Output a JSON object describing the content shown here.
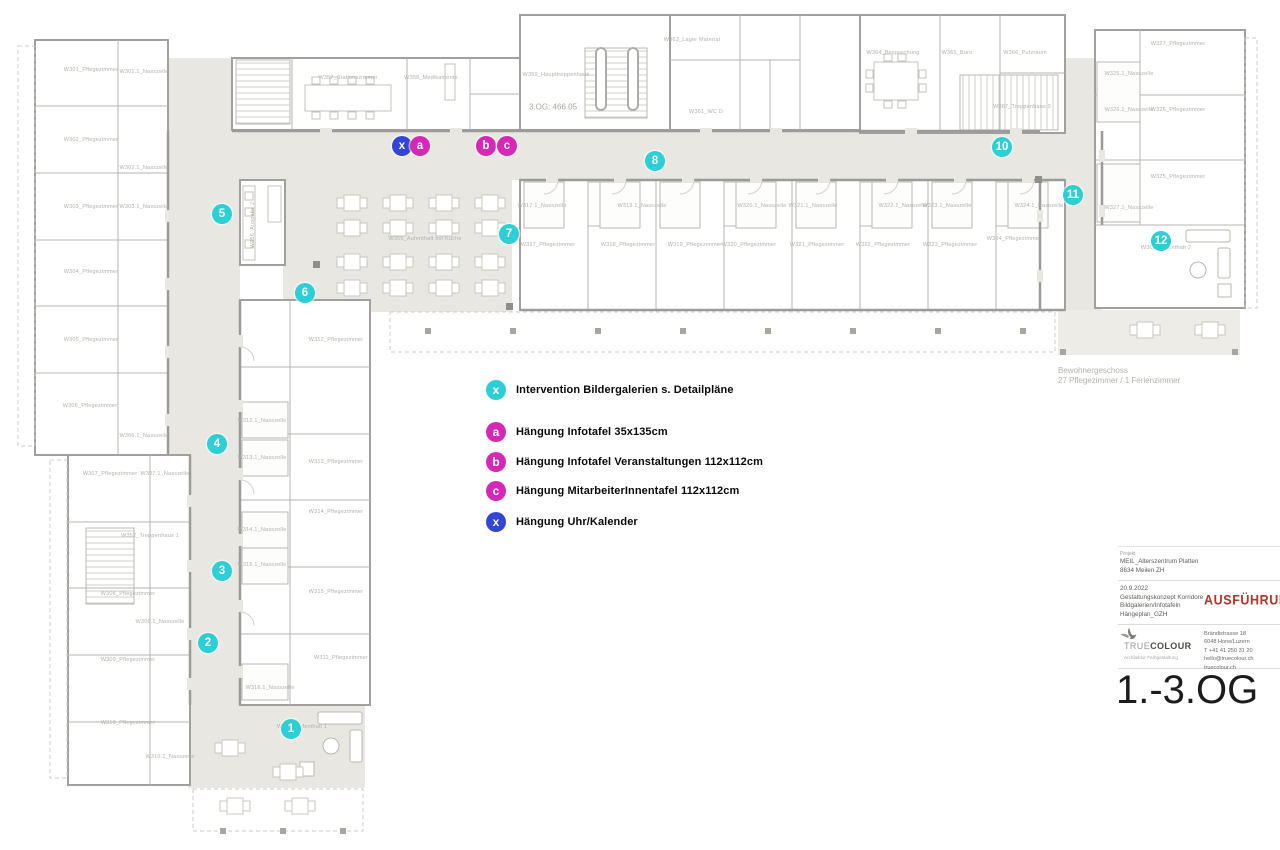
{
  "document": {
    "floor_title": "1.-3.OG",
    "level_note": "3.OG: 466.05",
    "area_note_line1": "Bewohnergeschoss",
    "area_note_line2": "27 Pflegezimmer / 1 Ferienzimmer"
  },
  "colors": {
    "cyan": "#2ccfd6",
    "magenta": "#d628b6",
    "blue": "#3345d4",
    "red": "#b23427",
    "corridor": "#e8e7e1"
  },
  "legend": {
    "items": [
      {
        "symbol": "x",
        "color": "cyan",
        "label": "Intervention Bildergalerien s. Detailpläne",
        "y": 390
      },
      {
        "symbol": "a",
        "color": "magenta",
        "label": "Hängung Infotafel 35x135cm",
        "y": 432
      },
      {
        "symbol": "b",
        "color": "magenta",
        "label": "Hängung Infotafel Veranstaltungen 112x112cm",
        "y": 462
      },
      {
        "symbol": "c",
        "color": "magenta",
        "label": "Hängung MitarbeiterInnentafel 112x112cm",
        "y": 491
      },
      {
        "symbol": "x",
        "color": "blue",
        "label": "Hängung Uhr/Kalender",
        "y": 522
      }
    ]
  },
  "markers": {
    "numbered": [
      {
        "label": "1",
        "x": 291,
        "y": 729
      },
      {
        "label": "2",
        "x": 208,
        "y": 643
      },
      {
        "label": "3",
        "x": 222,
        "y": 571
      },
      {
        "label": "4",
        "x": 217,
        "y": 444
      },
      {
        "label": "5",
        "x": 222,
        "y": 214
      },
      {
        "label": "6",
        "x": 305,
        "y": 293
      },
      {
        "label": "7",
        "x": 509,
        "y": 234
      },
      {
        "label": "8",
        "x": 655,
        "y": 161
      },
      {
        "label": "10",
        "x": 1002,
        "y": 147
      },
      {
        "label": "11",
        "x": 1073,
        "y": 195
      },
      {
        "label": "12",
        "x": 1161,
        "y": 241
      }
    ],
    "lettered": [
      {
        "label": "x",
        "color": "blue",
        "x": 402,
        "y": 146
      },
      {
        "label": "a",
        "color": "magenta",
        "x": 420,
        "y": 146
      },
      {
        "label": "b",
        "color": "magenta",
        "x": 486,
        "y": 146
      },
      {
        "label": "c",
        "color": "magenta",
        "x": 507,
        "y": 146
      }
    ]
  },
  "rooms": [
    {
      "label": "W301_Pflegezimmer",
      "x": 91,
      "y": 70
    },
    {
      "label": "W301.1_Nasszelle",
      "x": 144,
      "y": 72
    },
    {
      "label": "W302_Pflegezimmer",
      "x": 91,
      "y": 140
    },
    {
      "label": "W302.1_Nasszelle",
      "x": 144,
      "y": 168
    },
    {
      "label": "W303_Pflegezimmer",
      "x": 91,
      "y": 207
    },
    {
      "label": "W303.1_Nasszelle",
      "x": 144,
      "y": 207
    },
    {
      "label": "W304_Pflegezimmer",
      "x": 91,
      "y": 272
    },
    {
      "label": "W305_Pflegezimmer",
      "x": 91,
      "y": 340
    },
    {
      "label": "W306_Pflegezimmer",
      "x": 90,
      "y": 406
    },
    {
      "label": "W306.1_Nasszelle",
      "x": 144,
      "y": 436
    },
    {
      "label": "W307_Pflegezimmer",
      "x": 110,
      "y": 474
    },
    {
      "label": "W307.1_Nasszelle",
      "x": 165,
      "y": 474
    },
    {
      "label": "W308_Pflegezimmer",
      "x": 128,
      "y": 594
    },
    {
      "label": "W308.1_Nasszelle",
      "x": 160,
      "y": 622
    },
    {
      "label": "W309_Pflegezimmer",
      "x": 128,
      "y": 660
    },
    {
      "label": "W310_Pflegezimmer",
      "x": 128,
      "y": 723
    },
    {
      "label": "W310.1_Nasszelle",
      "x": 170,
      "y": 757
    },
    {
      "label": "W352_Treppenhaus 1",
      "x": 150,
      "y": 536
    },
    {
      "label": "W311_Pflegezimmer",
      "x": 341,
      "y": 658
    },
    {
      "label": "W312_Pflegezimmer",
      "x": 336,
      "y": 340
    },
    {
      "label": "W312.1_Nasszelle",
      "x": 262,
      "y": 421
    },
    {
      "label": "W313_Pflegezimmer",
      "x": 336,
      "y": 462
    },
    {
      "label": "W313.1_Nasszelle",
      "x": 262,
      "y": 458
    },
    {
      "label": "W314_Pflegezimmer",
      "x": 336,
      "y": 512
    },
    {
      "label": "W314.1_Nasszelle",
      "x": 262,
      "y": 530
    },
    {
      "label": "W315_Pflegezimmer",
      "x": 336,
      "y": 592
    },
    {
      "label": "W315.1_Nasszelle",
      "x": 262,
      "y": 565
    },
    {
      "label": "W316.1_Nasszelle",
      "x": 270,
      "y": 688
    },
    {
      "label": "W351_Aufenthalt 1",
      "x": 302,
      "y": 727
    },
    {
      "label": "W355_Aufenthalt mit Küche",
      "x": 425,
      "y": 239
    },
    {
      "label": "W356_Ausgabe 2",
      "x": 253,
      "y": 225,
      "v": 1
    },
    {
      "label": "W357_Stationszimmer",
      "x": 348,
      "y": 78
    },
    {
      "label": "W358_Medikamente",
      "x": 431,
      "y": 78
    },
    {
      "label": "W359_Haupttreppenhaus",
      "x": 556,
      "y": 75
    },
    {
      "label": "W363_Lager Material",
      "x": 692,
      "y": 40
    },
    {
      "label": "W361_WC D",
      "x": 706,
      "y": 112
    },
    {
      "label": "W364_Besprechung",
      "x": 893,
      "y": 53
    },
    {
      "label": "W365_Büro",
      "x": 957,
      "y": 53
    },
    {
      "label": "W366_Putzraum",
      "x": 1025,
      "y": 53
    },
    {
      "label": "W367_Treppenhaus 3",
      "x": 1022,
      "y": 107
    },
    {
      "label": "W317.1_Nasszelle",
      "x": 542,
      "y": 206
    },
    {
      "label": "W317_Pflegezimmer",
      "x": 548,
      "y": 245
    },
    {
      "label": "W318_Pflegezimmer",
      "x": 628,
      "y": 245
    },
    {
      "label": "W319.1_Nasszelle",
      "x": 642,
      "y": 206
    },
    {
      "label": "W319_Pflegezimmer",
      "x": 695,
      "y": 245
    },
    {
      "label": "W320.1_Nasszelle",
      "x": 762,
      "y": 206
    },
    {
      "label": "W320_Pflegezimmer",
      "x": 749,
      "y": 245
    },
    {
      "label": "W321.1_Nasszelle",
      "x": 813,
      "y": 206
    },
    {
      "label": "W321_Pflegezimmer",
      "x": 817,
      "y": 245
    },
    {
      "label": "W322.1_Nasszelle",
      "x": 903,
      "y": 206
    },
    {
      "label": "W322_Pflegezimmer",
      "x": 883,
      "y": 245
    },
    {
      "label": "W323.1_Nasszelle",
      "x": 947,
      "y": 206
    },
    {
      "label": "W323_Pflegezimmer",
      "x": 950,
      "y": 245
    },
    {
      "label": "W324.1_Nasszelle",
      "x": 1039,
      "y": 206
    },
    {
      "label": "W324_Pflegezimmer",
      "x": 1014,
      "y": 239
    },
    {
      "label": "W327_Pflegezimmer",
      "x": 1178,
      "y": 44
    },
    {
      "label": "W325.1_Nasszelle",
      "x": 1129,
      "y": 74
    },
    {
      "label": "W326.1_Nasszelle",
      "x": 1129,
      "y": 110
    },
    {
      "label": "W326_Pflegezimmer",
      "x": 1178,
      "y": 110
    },
    {
      "label": "W325_Pflegezimmer",
      "x": 1178,
      "y": 177
    },
    {
      "label": "W327.1_Nasszelle",
      "x": 1129,
      "y": 208
    },
    {
      "label": "W369_Aufenthalt 2",
      "x": 1166,
      "y": 248
    }
  ],
  "titleblock": {
    "project_label": "Projekt",
    "project_lines": [
      "MEIL_Alterszentrum Platten",
      "8634 Meilen ZH"
    ],
    "revision_lines": [
      "20.9.2022",
      "Gestaltungskonzept Korridore",
      "Bildgalerien/Infotafeln",
      "Hängeplan_GZH"
    ],
    "stamp": "AUSFÜHRUNG",
    "logo_text_light": "TRUE",
    "logo_text_bold": "COLOUR",
    "logo_subtitle": "Architektur Farbgestaltung",
    "address_lines": [
      "Brändistrasse 18",
      "6048 Horw/Luzern",
      "T +41 41 250 31 20",
      "hello@truecolour.ch",
      "truecolour.ch"
    ]
  }
}
